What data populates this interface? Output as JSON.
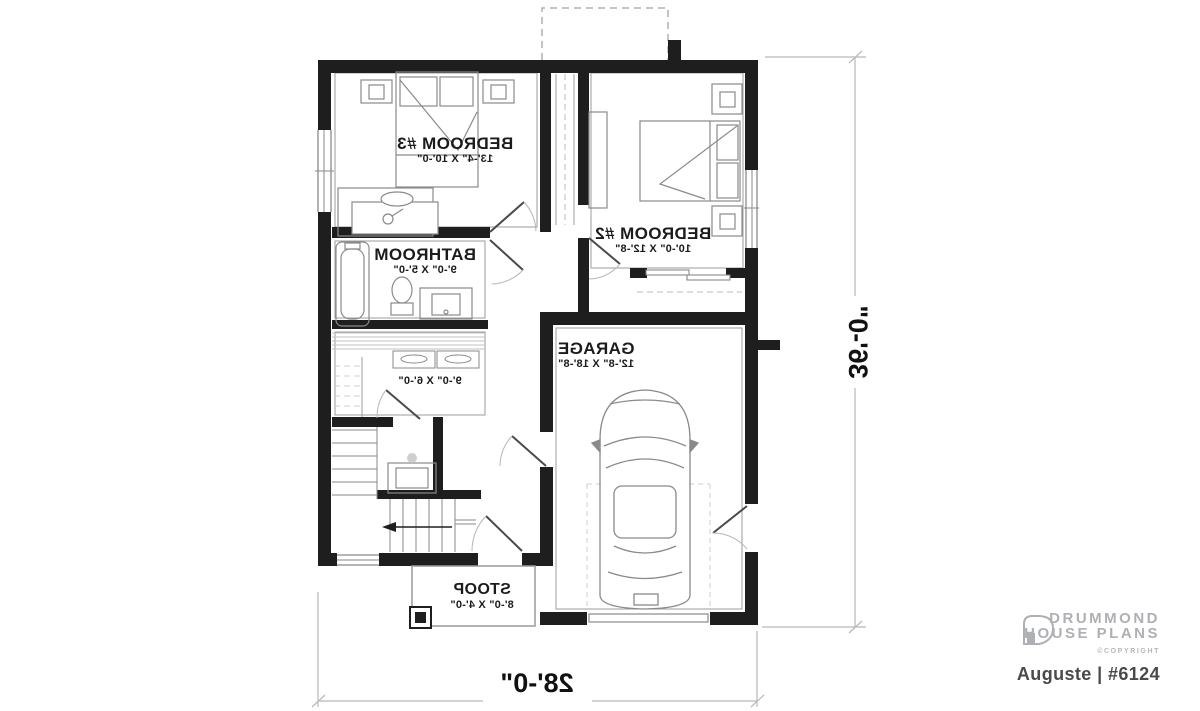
{
  "plan": {
    "rooms": {
      "bedroom3": {
        "name": "BEDROOM #3",
        "dims": "13'-4\" X 10'-0\""
      },
      "bedroom2": {
        "name": "BEDROOM #2",
        "dims": "10'-0\" X 12'-8\""
      },
      "bathroom": {
        "name": "BATHROOM",
        "dims": "9'-0\" X 5'-0\""
      },
      "utility": {
        "name": "",
        "dims": "9'-0\" X 6'-0\""
      },
      "garage": {
        "name": "GARAGE",
        "dims": "12'-8\" X 18'-8\""
      },
      "stoop": {
        "name": "STOOP",
        "dims": "8'-0\" X 4'-0\""
      }
    },
    "overall_dimensions": {
      "width": "28'-0\"",
      "depth": "36'-0\""
    }
  },
  "branding": {
    "logo_line1": "DRUMMOND",
    "logo_line2": "HOUSE PLANS",
    "copyright": "©COPYRIGHT",
    "plan_title": "Auguste | #6124"
  },
  "colors": {
    "wall": "#1e1e1e",
    "thin_line": "#8a8a8a",
    "dimension_line": "#b8b8b8",
    "label_text": "#1b1b1b",
    "logo_gray": "#aeb0b3",
    "title_gray": "#4a4a4c"
  }
}
